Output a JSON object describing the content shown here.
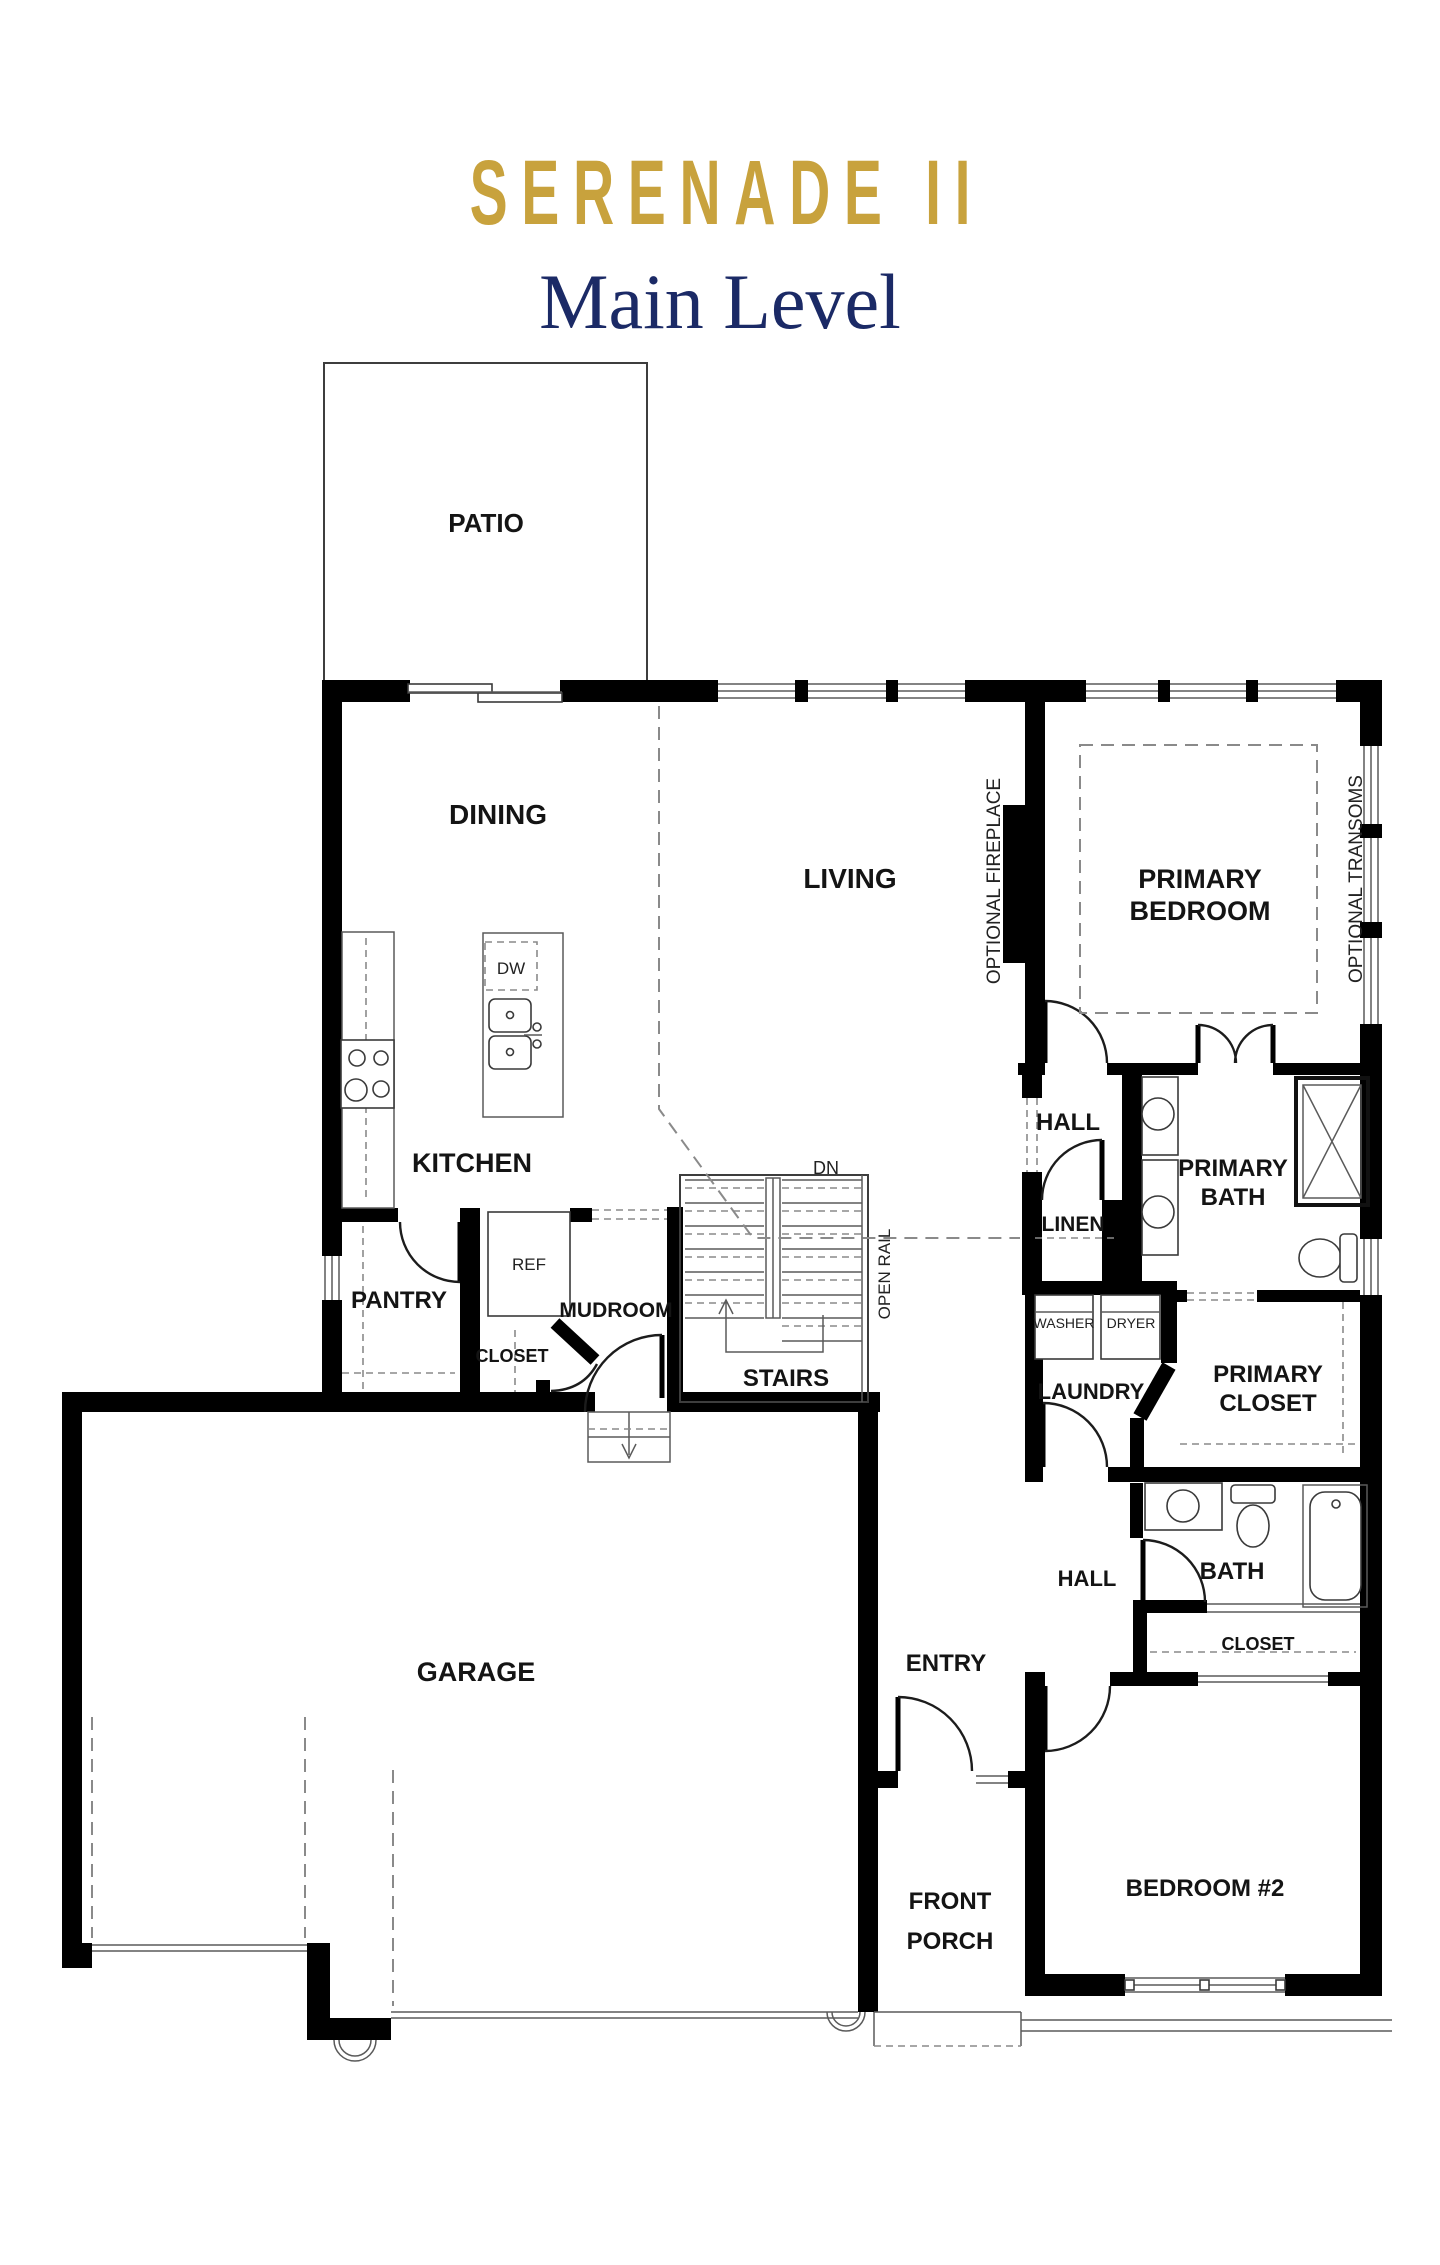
{
  "title": {
    "name": "SERENADE II",
    "subtitle": "Main Level"
  },
  "colors": {
    "title_gold": "#C8A23D",
    "subtitle_navy": "#1B2A66",
    "wall": "#000000"
  },
  "rooms": {
    "patio": "PATIO",
    "dining": "DINING",
    "living": "LIVING",
    "primary_bedroom": {
      "line1": "PRIMARY",
      "line2": "BEDROOM"
    },
    "kitchen": "KITCHEN",
    "pantry": "PANTRY",
    "mudroom": "MUDROOM",
    "mudroom_closet": "CLOSET",
    "stairs": "STAIRS",
    "upper_hall": "HALL",
    "linen": "LINEN",
    "primary_bath": {
      "line1": "PRIMARY",
      "line2": "BATH"
    },
    "laundry": "LAUNDRY",
    "primary_closet": {
      "line1": "PRIMARY",
      "line2": "CLOSET"
    },
    "garage": "GARAGE",
    "entry": "ENTRY",
    "lower_hall": "HALL",
    "bath": "BATH",
    "bedroom2_closet": "CLOSET",
    "front_porch": {
      "line1": "FRONT",
      "line2": "PORCH"
    },
    "bedroom2": "BEDROOM #2"
  },
  "appliances": {
    "dishwasher": "DW",
    "refrigerator": "REF",
    "washer": "WASHER",
    "dryer": "DRYER"
  },
  "annotations": {
    "stairs_direction": "DN",
    "open_rail": "OPEN RAIL",
    "optional_fireplace": "OPTIONAL FIREPLACE",
    "optional_transoms": "OPTIONAL TRANSOMS"
  }
}
